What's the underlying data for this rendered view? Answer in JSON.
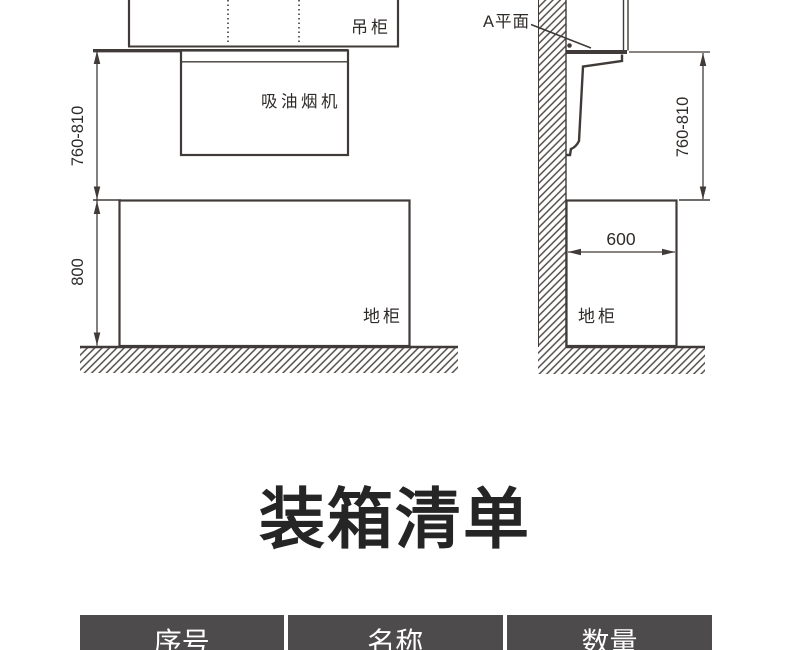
{
  "colors": {
    "line": "#403b38",
    "diagram_text": "#2e2b29",
    "table_header_bg": "#4d4b4b",
    "table_header_text": "#ffffff"
  },
  "diagram_front": {
    "labels": {
      "wall_cabinet": "吊柜",
      "hood": "吸油烟机",
      "base_cabinet": "地柜"
    },
    "dimensions": {
      "counter_to_hood": "760-810",
      "counter_height": "800"
    }
  },
  "diagram_side": {
    "labels": {
      "plane": "A平面",
      "base_cabinet": "地柜"
    },
    "dimensions": {
      "counter_to_hood": "760-810",
      "cabinet_depth": "600"
    }
  },
  "packing_list": {
    "heading": "装箱清单",
    "columns": [
      "序号",
      "名称",
      "数量"
    ]
  }
}
